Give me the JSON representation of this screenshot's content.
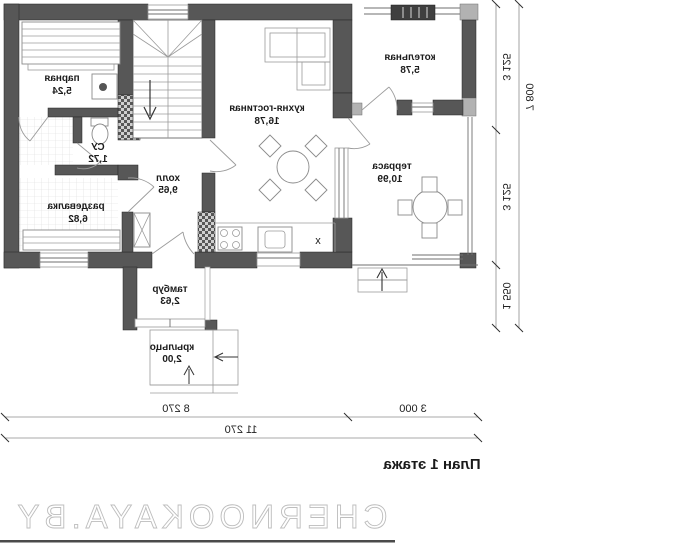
{
  "plan": {
    "rooms": [
      {
        "name": "парная",
        "area": "5,24"
      },
      {
        "name": "СУ",
        "area": "1,72"
      },
      {
        "name": "раздевалка",
        "area": "6,82"
      },
      {
        "name": "холл",
        "area": "9,65"
      },
      {
        "name": "кухня-гостиная",
        "area": "16,78"
      },
      {
        "name": "котельная",
        "area": "5,78"
      },
      {
        "name": "терраса",
        "area": "10,99"
      },
      {
        "name": "тамбур",
        "area": "2,63"
      },
      {
        "name": "крыльцо",
        "area": "2,00"
      }
    ],
    "dimensions": {
      "bottom_left": "8 270",
      "bottom_right": "3 000",
      "bottom_total": "11 270",
      "side_top": "3 125",
      "side_middle": "3 125",
      "side_bottom": "1 550",
      "side_total": "7 800"
    },
    "title": "План 1 этажа",
    "watermark": "CHERNOOKAYA.BY",
    "marks": {
      "cabinet": "x"
    },
    "colors": {
      "wall": "#575757",
      "pier": "#b2b2b2",
      "rule": "#4a4a4a"
    }
  }
}
